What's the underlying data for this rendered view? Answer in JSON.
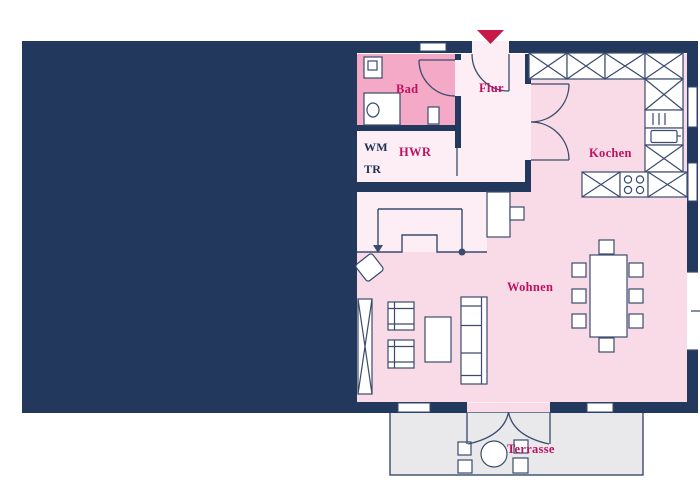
{
  "rooms": {
    "bad": {
      "label": "Bad"
    },
    "flur": {
      "label": "Flur"
    },
    "hwr": {
      "label": "HWR"
    },
    "kochen": {
      "label": "Kochen"
    },
    "wohnen": {
      "label": "Wohnen"
    },
    "terrasse": {
      "label": "Terrasse"
    }
  },
  "appliances": {
    "wm": "WM",
    "tr": "TR"
  },
  "colors": {
    "navy": "#22395d",
    "room_pink": "#f9dbe7",
    "light_pink": "#fceef4",
    "bad_pink": "#f4a9c6",
    "terrace_grey": "#e9e9eb",
    "outline": "#3a4b6d",
    "label_crimson": "#c01161",
    "text_navy": "#1c3156",
    "arrow_red": "#c9174a",
    "white": "#ffffff"
  }
}
